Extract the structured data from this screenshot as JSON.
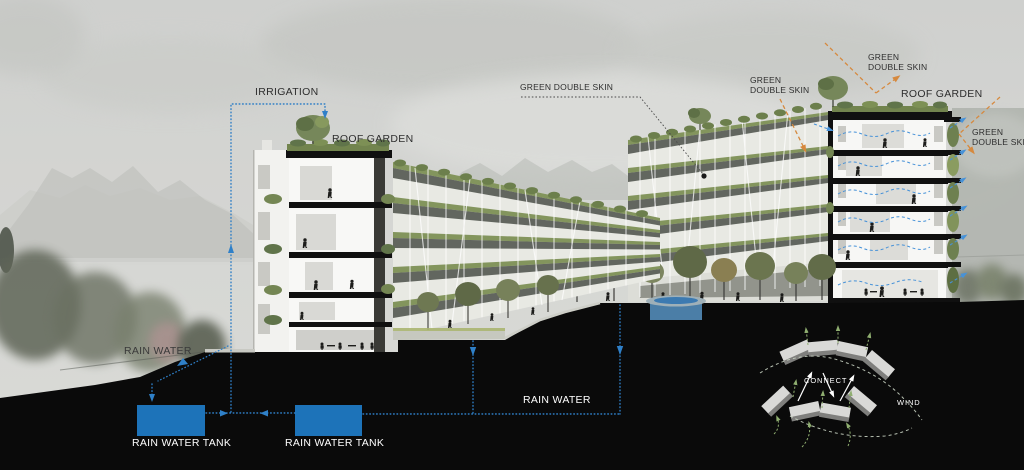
{
  "labels": {
    "irrigation": "IRRIGATION",
    "roof_garden": "ROOF GARDEN",
    "green_double_skin": "GREEN DOUBLE SKIN",
    "green": "GREEN",
    "double_skin": "DOUBLE SKIN",
    "rain_water": "RAIN WATER",
    "rain_water_tank": "RAIN WATER TANK",
    "connect": "CONNECT",
    "wind": "WIND"
  },
  "colors": {
    "water_tank_blue": "#1d73b9",
    "water_line_blue": "#2e7ec6",
    "airflow_blue": "#4792d8",
    "solar_orange": "#d6893e",
    "wind_arrow_green": "#8fae70",
    "vegetation_green": "#7d9055",
    "ground_section_black": "#0a0a0a",
    "sky_gray": "#d3d4d1"
  }
}
